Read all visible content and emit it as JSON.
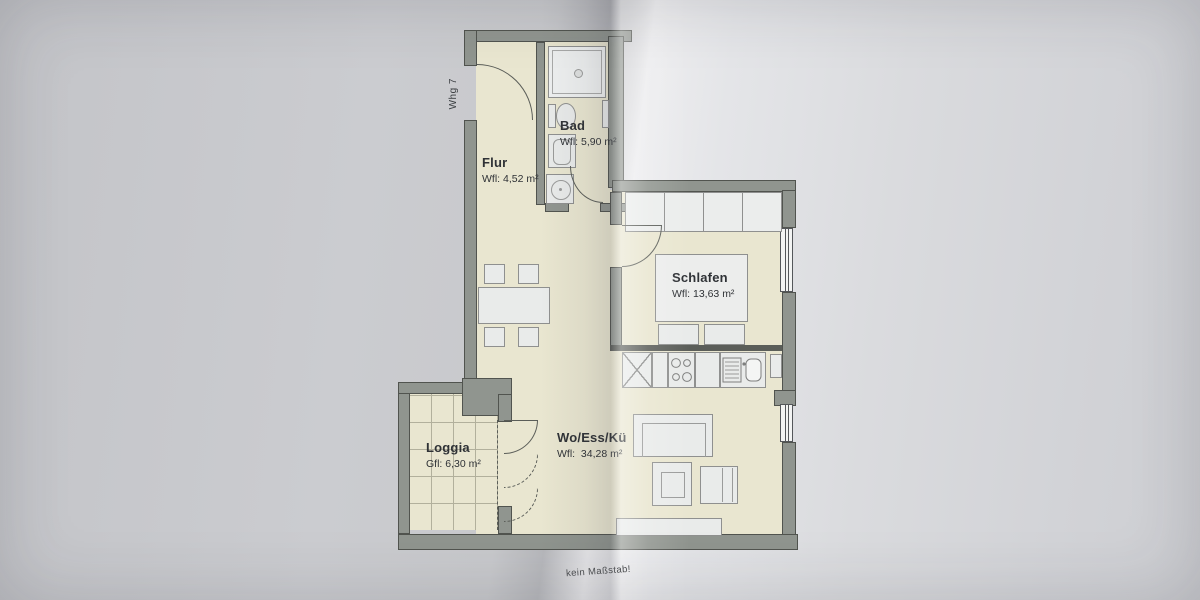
{
  "plan": {
    "apartment_label": "Whg 7",
    "scale_note": "kein Maßstab!",
    "rooms": [
      {
        "name": "Flur",
        "area": "Wfl: 4,52 m²"
      },
      {
        "name": "Bad",
        "area": "Wfl: 5,90 m²"
      },
      {
        "name": "Schlafen",
        "area": "Wfl: 13,63 m²"
      },
      {
        "name": "Wo/Ess/Kü",
        "area": "Wfl:  34,28 m²"
      },
      {
        "name": "Loggia",
        "area": "Gfl: 6,30 m²"
      }
    ],
    "colors": {
      "floor": "#e9e6d0",
      "wall": "#90958f",
      "furniture": "#e9ebea",
      "paper_left": "#c7c8cb",
      "paper_right": "#d9dadd",
      "text": "#2f3236"
    }
  }
}
